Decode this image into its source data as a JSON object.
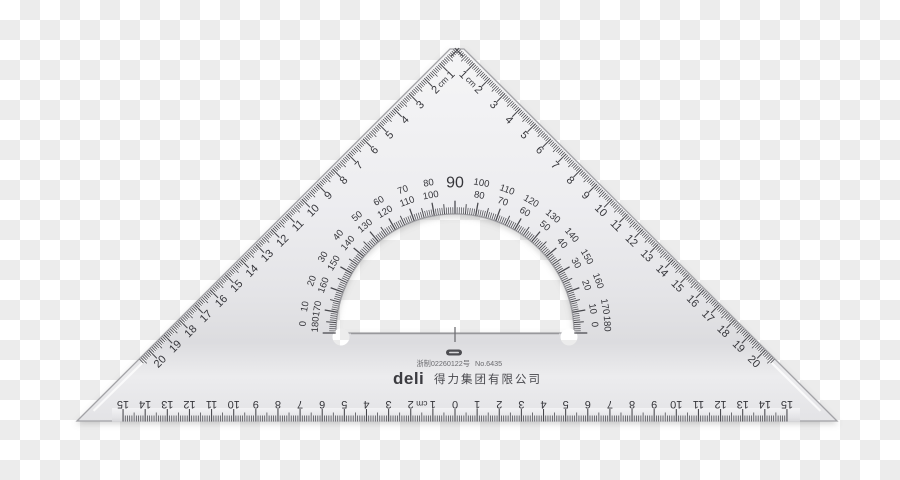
{
  "background": {
    "checker_light": "#ffffff",
    "checker_dark": "#ececec",
    "square_px": 20
  },
  "colors": {
    "plastic_top": "#f5f5f6",
    "plastic_mid": "#e9e9ec",
    "plastic_dark_band": "#dedee2",
    "plastic_bottom": "#eaeaed",
    "ink": "#35353a",
    "tick": "#47474c",
    "edge_line": "#9c9ca0",
    "faint_line": "#98989c",
    "logo_dark": "#4e4e52",
    "subtext": "#6a6a6e"
  },
  "hypotenuse_scale": {
    "unit": "cm",
    "numbers": [
      1,
      2,
      3,
      4,
      5,
      6,
      7,
      8,
      9,
      10,
      11,
      12,
      13,
      14,
      15,
      16,
      17,
      18,
      19,
      20
    ]
  },
  "bottom_scale": {
    "unit": "cm",
    "zero_label": "0",
    "numbers": [
      1,
      2,
      3,
      4,
      5,
      6,
      7,
      8,
      9,
      10,
      11,
      12,
      13,
      14,
      15
    ]
  },
  "protractor": {
    "outer_degrees": [
      0,
      10,
      20,
      30,
      40,
      50,
      60,
      70,
      80,
      90,
      100,
      110,
      120,
      130,
      140,
      150,
      160,
      170,
      180
    ],
    "inner_degrees": [
      180,
      170,
      160,
      150,
      140,
      130,
      120,
      110,
      100,
      90,
      80,
      70,
      60,
      50,
      40,
      30,
      20,
      10,
      0
    ],
    "apex_label": "90"
  },
  "branding": {
    "license": "浙制02260122号",
    "model": "No.6435",
    "brand": "deli",
    "company": "得力集团有限公司"
  }
}
